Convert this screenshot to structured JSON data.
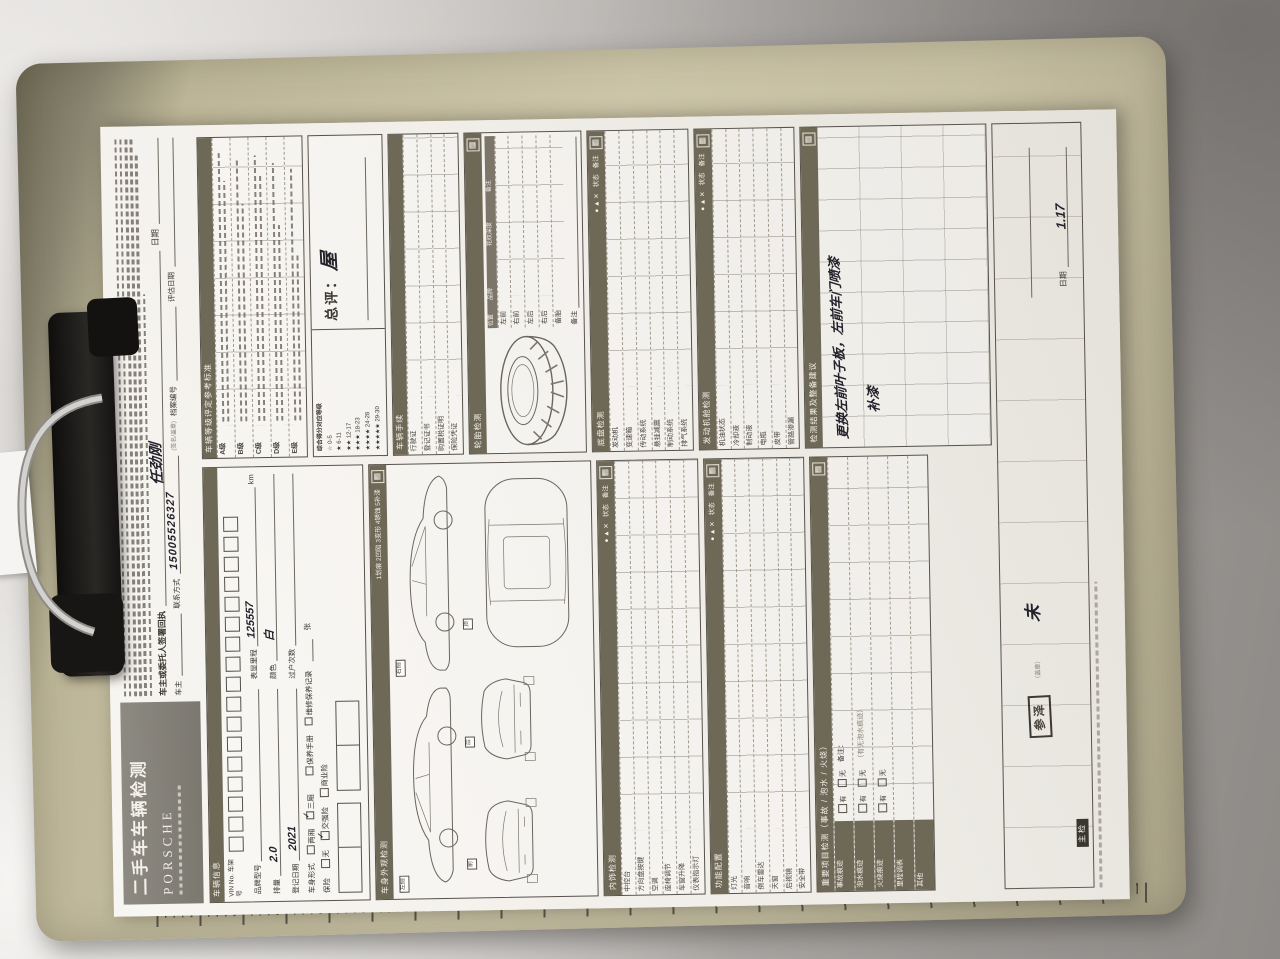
{
  "colors": {
    "section_bar": "#6e6857",
    "clipboard": "#c6bfa2",
    "ink": "#23222b",
    "paper": "#f1eee9"
  },
  "icons": {
    "section": "▦"
  },
  "title": {
    "main": "二手车车辆检测",
    "brand": "PORSCHE"
  },
  "header": {
    "receipt_label": "车主或委托人签署回执",
    "receipt_date_label": "日期",
    "sign_hint": "(签名/盖章)",
    "signature": "任劲刚"
  },
  "owner": {
    "owner_label": "车主",
    "contact_label": "联系方式",
    "contact_value": "15005526327",
    "file_label": "档案编号",
    "eval_label": "评估日期"
  },
  "vehicle": {
    "title": "车辆信息",
    "vin_label": "VIN No. 车架号",
    "f1": "品牌型号",
    "f1v": "",
    "f2": "表显里程",
    "f2v": "125557",
    "f2u": "km",
    "f3": "排量",
    "f3v": "2.0",
    "f4": "颜色",
    "f4v": "白",
    "f5": "登记日期",
    "f5v": "2021",
    "f6": "过户次数",
    "f6v": "",
    "body_label": "车身形式",
    "opt_a": "两厢",
    "opt_b": "三厢",
    "doc_a": "保养手册",
    "doc_b": "维修保养记录",
    "doc_suffix": "张",
    "ins_label": "保险",
    "ins_a": "无",
    "ins_b": "交强险",
    "ins_c": "商业险",
    "check": "✓"
  },
  "grade": {
    "title": "车辆等级评定参考标准",
    "rows": [
      "A级",
      "B级",
      "C级",
      "D级",
      "E级"
    ],
    "legend_title": "综合得分对应等级",
    "legend": [
      "☆ 0-5",
      "★ 6-11",
      "★★ 12-17",
      "★★★ 18-23",
      "★★★★ 24-28",
      "★★★★★ 29-30"
    ],
    "rating_label": "总评：",
    "rating_value": "屋"
  },
  "docs": {
    "title": "车辆手续",
    "rows": [
      "行驶证",
      "登记证书",
      "购置税证明",
      "保险凭证"
    ]
  },
  "exterior": {
    "title": "车身外观检测",
    "legend": "1划痕 2凹陷 3变形 4锈蚀 5补漆",
    "tags": [
      "左侧",
      "右侧",
      "前",
      "后",
      "顶"
    ]
  },
  "tire": {
    "title": "轮胎检测",
    "cols": [
      "位置",
      "品牌",
      "花纹深度",
      "备注"
    ],
    "rows": [
      "左前",
      "右前",
      "左后",
      "右后",
      "备胎"
    ],
    "note": "备注"
  },
  "mech1": {
    "title": "底盘检测",
    "status": "状态",
    "leg": "● ▲ ✕",
    "note": "备注",
    "rows": [
      "发动机",
      "变速箱",
      "传动系统",
      "悬挂减震",
      "制动系统",
      "排气系统"
    ]
  },
  "mech2": {
    "title": "发动机舱检测",
    "status": "状态",
    "leg": "● ▲ ✕",
    "note": "备注",
    "rows": [
      "机油状态",
      "冷却液",
      "制动液",
      "电瓶",
      "皮带",
      "管路渗漏"
    ]
  },
  "int1": {
    "title": "内饰检测",
    "status": "状态",
    "leg": "● ▲ ✕",
    "note": "备注",
    "rows": [
      "中控台",
      "方向盘按键",
      "空调",
      "座椅调节",
      "车窗升降",
      "仪表指示灯"
    ]
  },
  "int2": {
    "title": "功能配置",
    "status": "状态",
    "leg": "● ▲ ✕",
    "note": "备注",
    "rows": [
      "灯光",
      "音响",
      "倒车雷达",
      "天窗",
      "后视镜",
      "安全带"
    ]
  },
  "accident": {
    "title": "重要项目检测（事故 / 泡水 / 火烧）",
    "yes": "有",
    "no": "无",
    "note_label": "备注：",
    "hint": "（有无泡水痕迹）",
    "rows": [
      "事故痕迹",
      "泡水痕迹",
      "火烧痕迹",
      "里程调表",
      "其他"
    ]
  },
  "result": {
    "title": "检测结果及整备建议",
    "line1": "更换左前叶子板，左前车门喷漆",
    "line2": "补漆"
  },
  "footer": {
    "stamp": "参泽",
    "stamp_hint": "（盖章）",
    "extra": "未",
    "date_label": "日期",
    "date_value": "1.17",
    "tag": "主检"
  }
}
